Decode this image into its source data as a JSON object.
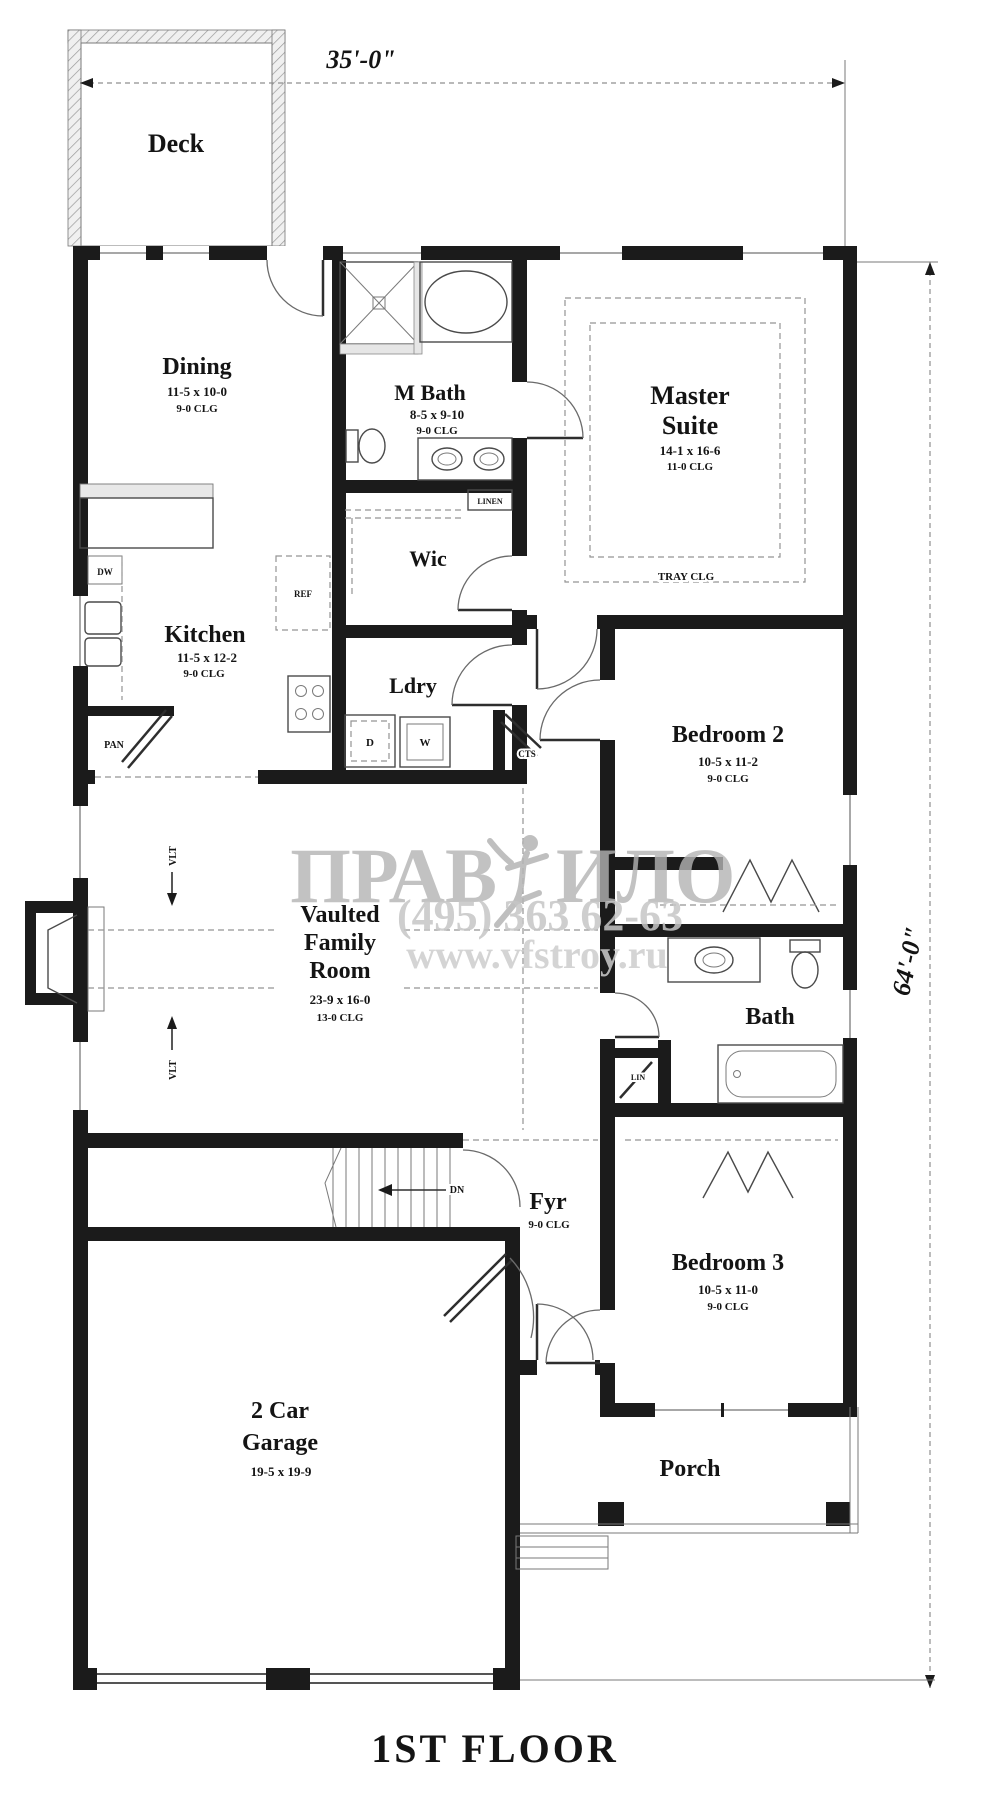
{
  "title": "1ST FLOOR",
  "dimensions": {
    "width": "35'-0\"",
    "height": "64'-0\""
  },
  "watermark": {
    "part1": "ПРАВ",
    "part2": "ИЛО",
    "phone": "(495) 363 62-63",
    "site": "www.vfstroy.ru"
  },
  "rooms": {
    "deck": {
      "name": "Deck"
    },
    "dining": {
      "name": "Dining",
      "size": "11-5 x 10-0",
      "ceiling": "9-0 CLG"
    },
    "mbath": {
      "name": "M Bath",
      "size": "8-5 x 9-10",
      "ceiling": "9-0 CLG"
    },
    "master": {
      "name1": "Master",
      "name2": "Suite",
      "size": "14-1 x 16-6",
      "ceiling": "11-0 CLG",
      "note": "TRAY CLG"
    },
    "wic": {
      "name": "Wic"
    },
    "kitchen": {
      "name": "Kitchen",
      "size": "11-5 x 12-2",
      "ceiling": "9-0 CLG"
    },
    "laundry": {
      "name": "Ldry"
    },
    "bedroom2": {
      "name": "Bedroom 2",
      "size": "10-5 x 11-2",
      "ceiling": "9-0 CLG"
    },
    "family": {
      "name1": "Vaulted",
      "name2": "Family",
      "name3": "Room",
      "size": "23-9 x 16-0",
      "ceiling": "13-0 CLG"
    },
    "bath": {
      "name": "Bath"
    },
    "bedroom3": {
      "name": "Bedroom 3",
      "size": "10-5 x 11-0",
      "ceiling": "9-0 CLG"
    },
    "foyer": {
      "name": "Fyr",
      "ceiling": "9-0 CLG"
    },
    "garage": {
      "name1": "2 Car",
      "name2": "Garage",
      "size": "19-5 x 19-9"
    },
    "porch": {
      "name": "Porch"
    }
  },
  "labels": {
    "dw": "DW",
    "ref": "REF",
    "pan": "PAN",
    "linen": "LINEN",
    "cts": "CTS",
    "dryer": "D",
    "washer": "W",
    "lin": "LIN",
    "dn": "DN",
    "vlt": "VLT"
  }
}
